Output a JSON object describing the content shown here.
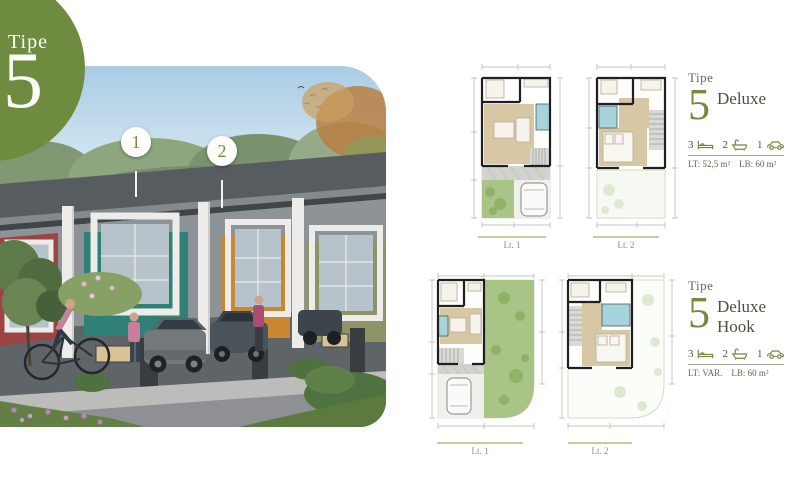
{
  "badge": {
    "label": "Tipe",
    "number": "5"
  },
  "photo": {
    "marker1": "1",
    "marker2": "2"
  },
  "deluxe": {
    "tipe_label": "Tipe",
    "type_number": "5",
    "type_name": "Deluxe",
    "bed_count": "3",
    "bath_count": "2",
    "car_count": "1",
    "area_lt": "LT: 52,5 m²",
    "area_lb": "LB: 60 m²",
    "floor1_label": "Lt. 1",
    "floor2_label": "Lt. 2"
  },
  "deluxe_hook": {
    "tipe_label": "Tipe",
    "type_number": "5",
    "type_name_line1": "Deluxe",
    "type_name_line2": "Hook",
    "bed_count": "3",
    "bath_count": "2",
    "car_count": "1",
    "area_lt": "LT: VAR.",
    "area_lb": "LB: 60 m²",
    "floor1_label": "Lt. 1",
    "floor2_label": "Lt. 2"
  },
  "colors": {
    "brand_green": "#6f8b3f",
    "garden_green": "#a9c487",
    "floor_beige": "#d8c7a5",
    "bath_blue": "#a7d4db"
  }
}
